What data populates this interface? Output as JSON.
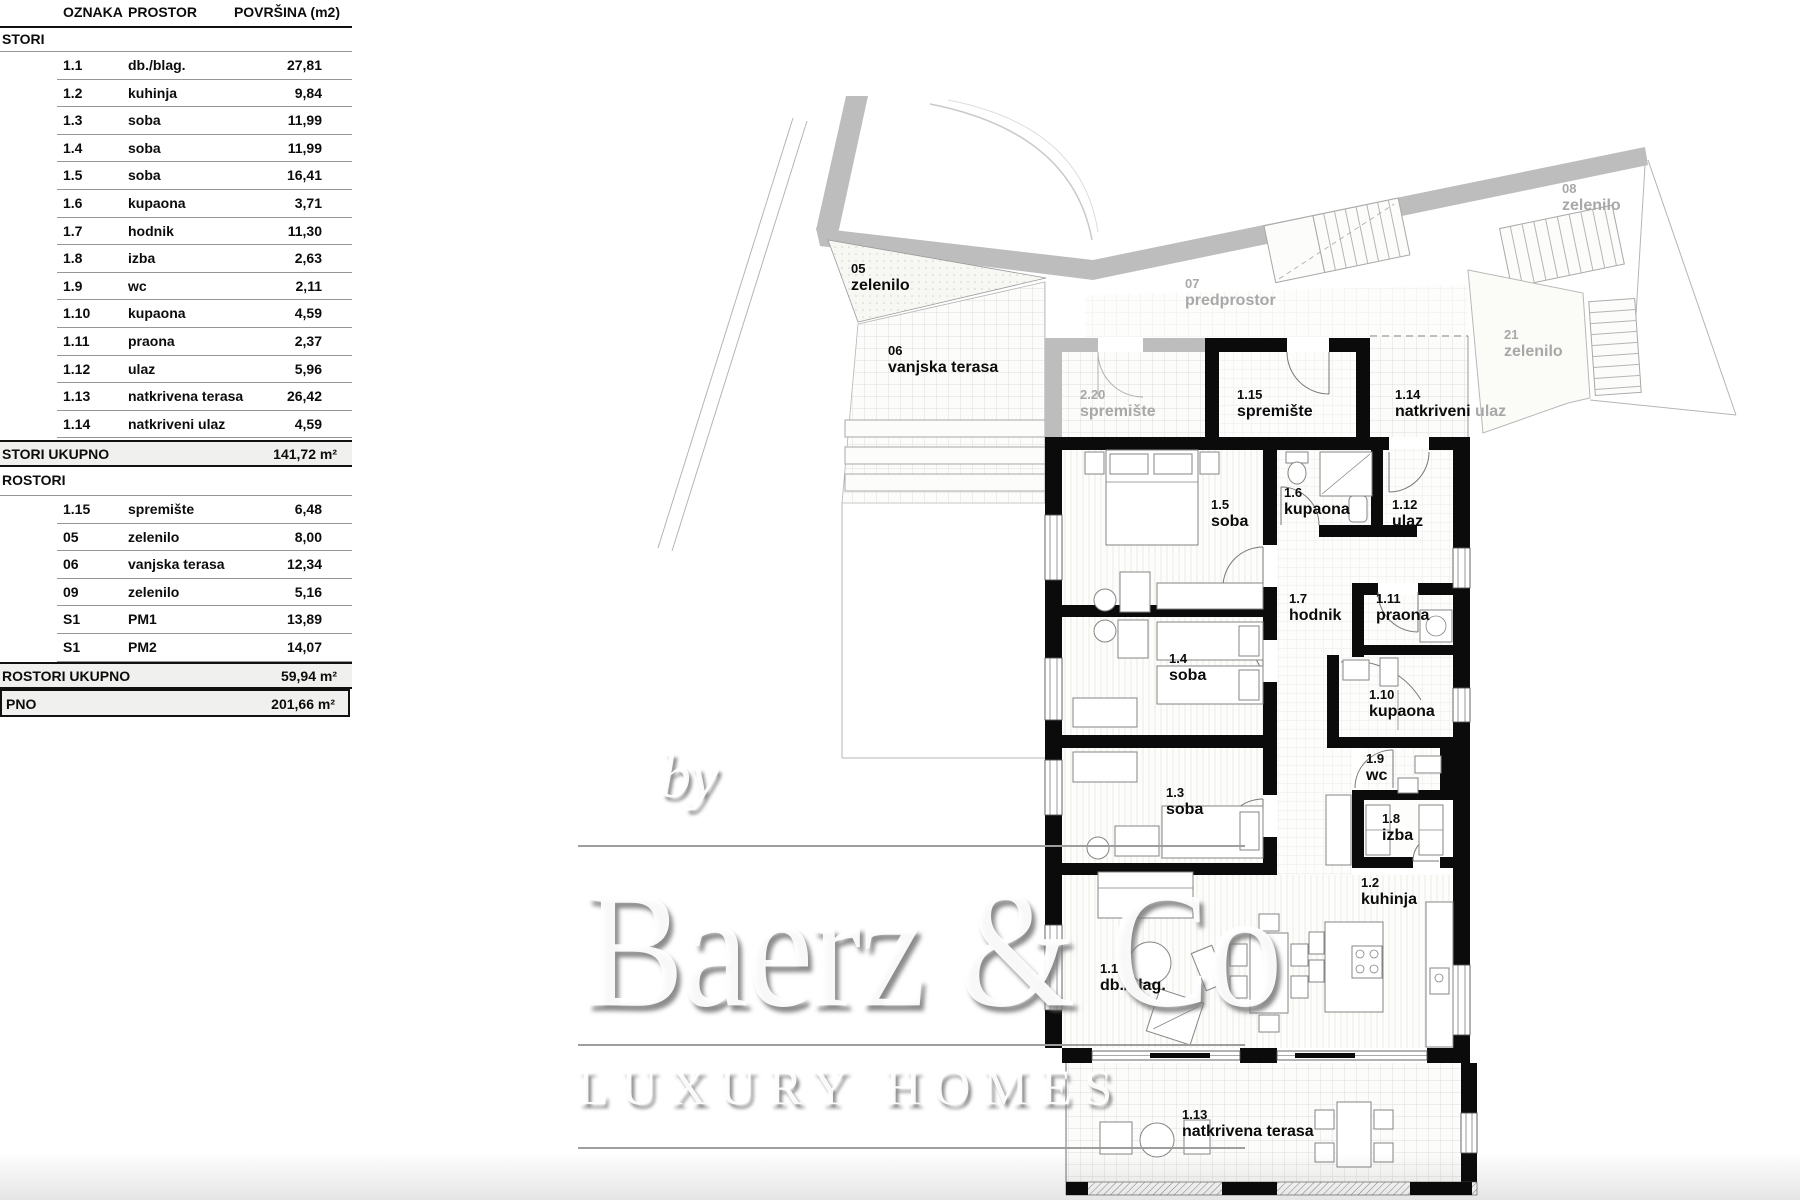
{
  "table": {
    "headers": [
      "OZNAKA",
      "PROSTOR",
      "POVRŠINA (m2)"
    ],
    "sections": [
      {
        "title": "STORI",
        "rows": [
          {
            "code": "1.1",
            "name": "db./blag.",
            "area": "27,81"
          },
          {
            "code": "1.2",
            "name": "kuhinja",
            "area": "9,84"
          },
          {
            "code": "1.3",
            "name": "soba",
            "area": "11,99"
          },
          {
            "code": "1.4",
            "name": "soba",
            "area": "11,99"
          },
          {
            "code": "1.5",
            "name": "soba",
            "area": "16,41"
          },
          {
            "code": "1.6",
            "name": "kupaona",
            "area": "3,71"
          },
          {
            "code": "1.7",
            "name": "hodnik",
            "area": "11,30"
          },
          {
            "code": "1.8",
            "name": "izba",
            "area": "2,63"
          },
          {
            "code": "1.9",
            "name": "wc",
            "area": "2,11"
          },
          {
            "code": "1.10",
            "name": "kupaona",
            "area": "4,59"
          },
          {
            "code": "1.11",
            "name": "praona",
            "area": "2,37"
          },
          {
            "code": "1.12",
            "name": "ulaz",
            "area": "5,96"
          },
          {
            "code": "1.13",
            "name": "natkrivena terasa",
            "area": "26,42"
          },
          {
            "code": "1.14",
            "name": "natkriveni ulaz",
            "area": "4,59"
          }
        ],
        "total_label": "STORI UKUPNO",
        "total_value": "141,72 m²"
      },
      {
        "title": "ROSTORI",
        "rows": [
          {
            "code": "1.15",
            "name": "spremište",
            "area": "6,48"
          },
          {
            "code": "05",
            "name": "zelenilo",
            "area": "8,00"
          },
          {
            "code": "06",
            "name": "vanjska terasa",
            "area": "12,34"
          },
          {
            "code": "09",
            "name": "zelenilo",
            "area": "5,16"
          },
          {
            "code": "S1",
            "name": "PM1",
            "area": "13,89"
          },
          {
            "code": "S1",
            "name": "PM2",
            "area": "14,07"
          }
        ],
        "total_label": "ROSTORI UKUPNO",
        "total_value": "59,94 m²"
      }
    ],
    "grand_total": {
      "label": "PNO",
      "value": "201,66 m²"
    }
  },
  "plan": {
    "labels": [
      {
        "code": "05",
        "name": "zelenilo"
      },
      {
        "code": "06",
        "name": "vanjska terasa"
      },
      {
        "code": "2.20",
        "name": "spremište"
      },
      {
        "code": "07",
        "name": "predprostor"
      },
      {
        "code": "08",
        "name": "zelenilo"
      },
      {
        "code": "21",
        "name": "zelenilo"
      },
      {
        "code": "1.15",
        "name": "spremište"
      },
      {
        "code": "1.14",
        "name": "natkriveni",
        "suffix": "ulaz"
      },
      {
        "code": "1.5",
        "name": "soba"
      },
      {
        "code": "1.6",
        "name": "kupaona"
      },
      {
        "code": "1.12",
        "name": "ulaz"
      },
      {
        "code": "1.7",
        "name": "hodnik"
      },
      {
        "code": "1.11",
        "name": "praona"
      },
      {
        "code": "1.4",
        "name": "soba"
      },
      {
        "code": "1.10",
        "name": "kupaona"
      },
      {
        "code": "1.9",
        "name": "wc"
      },
      {
        "code": "1.3",
        "name": "soba"
      },
      {
        "code": "1.8",
        "name": "izba"
      },
      {
        "code": "1.2",
        "name": "kuhinja"
      },
      {
        "code": "1.1",
        "name": "db./blag."
      },
      {
        "code": "1.13",
        "name": "natkrivena terasa"
      }
    ]
  },
  "watermark": {
    "by": "by",
    "brand": "Baerz & Co",
    "tagline": "LUXURY HOMES"
  },
  "colors": {
    "wall": "#0b0b0b",
    "site_gray": "#bdbdbd",
    "label_gray": "#a8a8a8",
    "text": "#0c0c0c"
  }
}
